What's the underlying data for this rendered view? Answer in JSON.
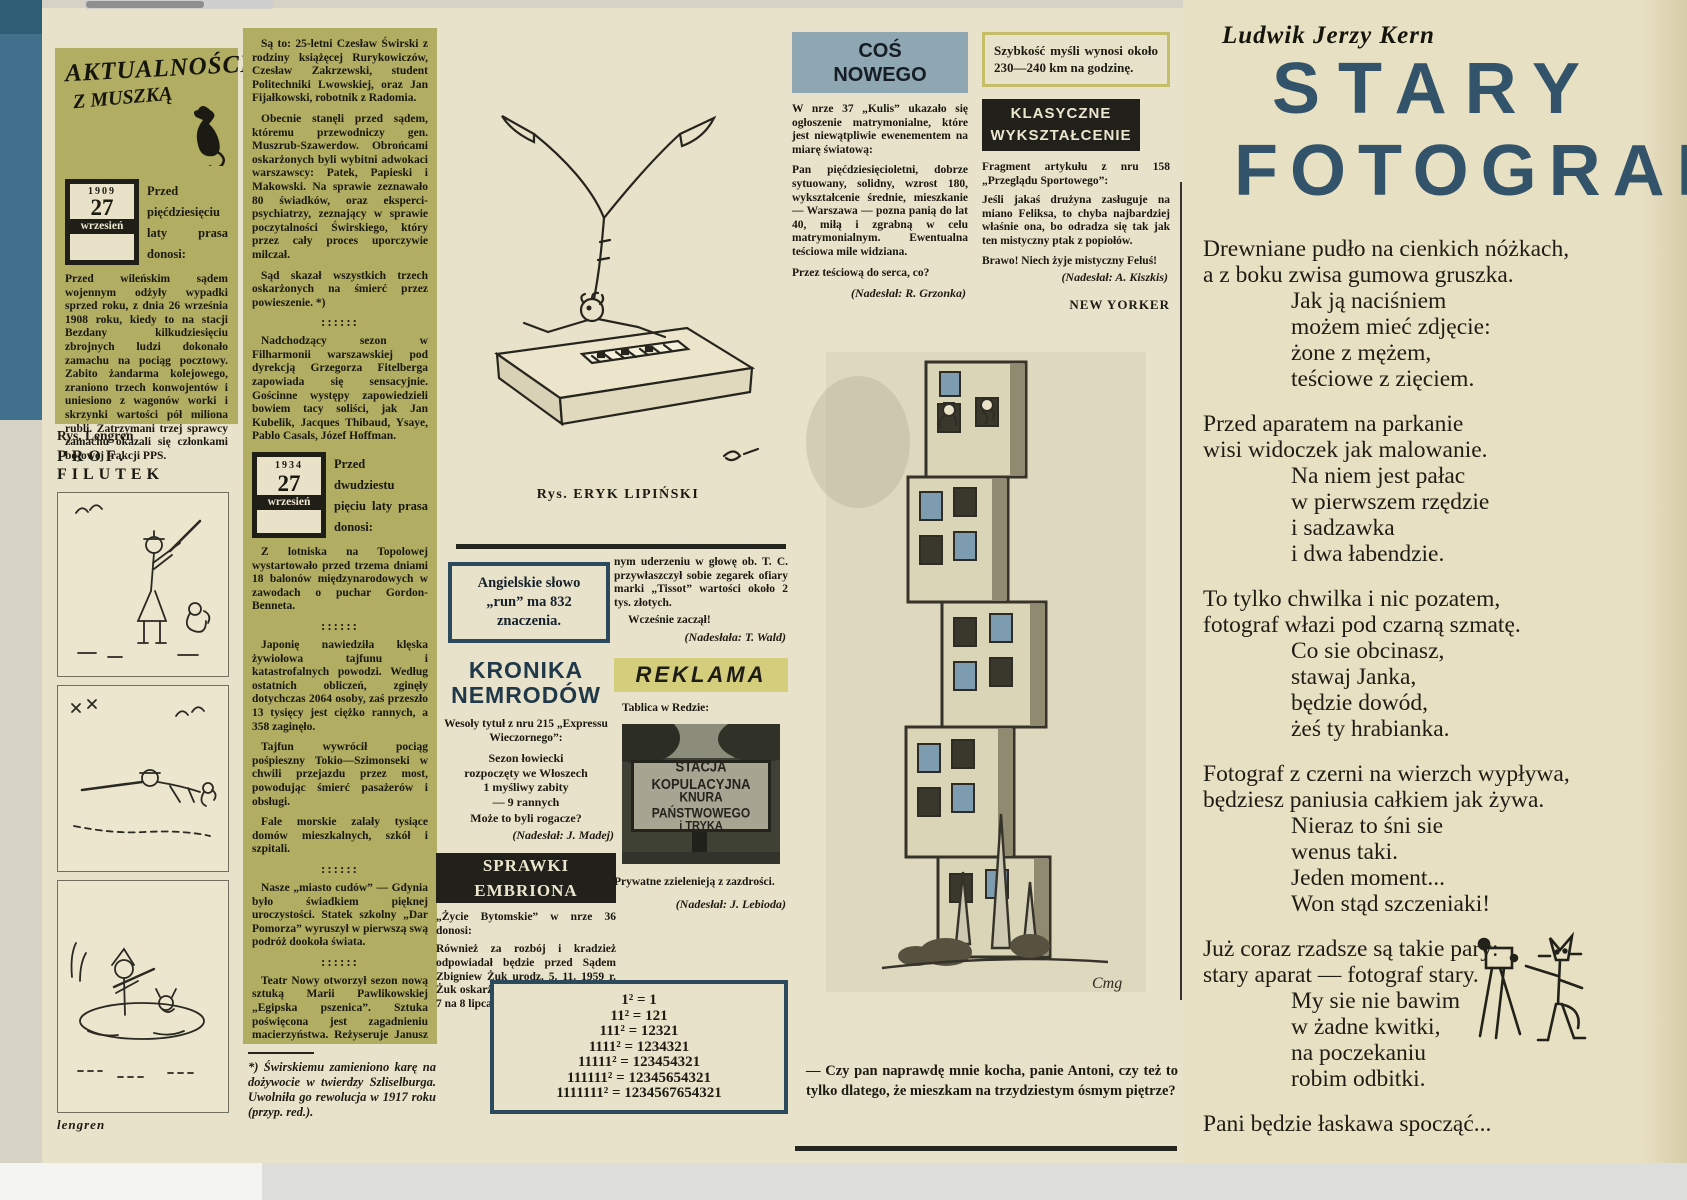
{
  "colors": {
    "paper_left": "#e9e2ca",
    "paper_right": "#e8e0c2",
    "panel_green": "#b1ad62",
    "band_blue": "#8ea7b2",
    "band_yellow": "#d4cd7c",
    "banner_black": "#21201a",
    "headline_blue": "#20394a",
    "poem_title_blue": "#33536b",
    "edge_blue": "#40708b",
    "ink": "#1c1b12"
  },
  "aktualnosci": {
    "logo1": "AKTUALNOŚCI",
    "logo2": "Z MUSZKĄ",
    "box1909": {
      "year": "1909",
      "day": "27",
      "month": "wrzesień"
    },
    "lead1909": "Przed pięćdziesięciu laty prasa donosi:",
    "para1909": "Przed wileńskim sądem wojennym odżyły wypadki sprzed roku, z dnia 26 września 1908 roku, kiedy to na stacji Bezdany kilkudziesięciu zbrojnych ludzi dokonało zamachu na pociąg pocztowy. Zabito żandarma kolejowego, zraniono trzech konwojentów i uniesiono z wagonów worki i skrzynki wartości pół miliona rubli. Zatrzymani trzej sprawcy zamachu okazali się członkami bojowej frakcji PPS.",
    "rys": "Rys. Lengren",
    "filutek": "PROF. FILUTEK",
    "signature": "lengren"
  },
  "col2": {
    "para_a": "Są to: 25-letni Czesław Świrski z rodziny książęcej Rurykowiczów, Czesław Zakrzewski, student Politechniki Lwowskiej, oraz Jan Fijałkowski, robotnik z Radomia.",
    "para_b": "Obecnie stanęli przed sądem, któremu przewodniczy gen. Muszrub-Szawerdow. Obrońcami oskarżonych byli wybitni adwokaci warszawscy: Patek, Papieski i Makowski. Na sprawie zeznawało 80 świadków, oraz eksperci-psychiatrzy, zeznający w sprawie poczytalności Świrskiego, który przez cały proces uporczywie milczał.",
    "para_c": "Sąd skazał wszystkich trzech oskarżonych na śmierć przez powieszenie. *)",
    "sep": "::::::",
    "para_d": "Nadchodzący sezon w Filharmonii warszawskiej pod dyrekcją Grzegorza Fitelberga zapowiada się sensacyjnie. Gościnne występy zapowiedzieli bowiem tacy soliści, jak Jan Kubelik, Jacques Thibaud, Ysaye, Pablo Casals, Józef Hoffman.",
    "box1934": {
      "year": "1934",
      "day": "27",
      "month": "wrzesień"
    },
    "lead1934": "Przed dwudziestu pięciu laty prasa donosi:",
    "para_e": "Z lotniska na Topolowej wystartowało przed trzema dniami 18 balonów międzynarodowych w zawodach o puchar Gordon-Benneta.",
    "para_f": "Japonię nawiedziła klęska żywiołowa tajfunu i katastrofalnych powodzi. Według ostatnich obliczeń, zginęły dotychczas 2064 osoby, zaś przeszło 13 tysięcy jest ciężko rannych, a 358 zaginęło.",
    "para_g": "Tajfun wywrócił pociąg pośpieszny Tokio—Szimonseki w chwili przejazdu przez most, powodując śmierć pasażerów i obsługi.",
    "para_h": "Fale morskie zalały tysiące domów mieszkalnych, szkół i szpitali.",
    "para_i": "Nasze „miasto cudów” — Gdynia było świadkiem pięknej uroczystości. Statek szkolny „Dar Pomorza” wyruszył w pierwszą swą podróż dookoła świata.",
    "para_j": "Teatr Nowy otworzył sezon nową sztuką Marii Pawlikowskiej „Egipska pszenica”. Sztuka poświęcona jest zagadnieniu macierzyństwa. Reżyseruje Janusz Warnecki Grają Dulębianka, Gorczyńska, Buczyńska, Brodniewicz i Pośpielowski.",
    "sig": "(kar. beyl.)",
    "footnote": "*) Świrskiemu zamieniono karę na dożywocie w twierdzy Szliselburga. Uwolniła go rewolucja w 1917 roku (przyp. red.)."
  },
  "lipinski": {
    "caption": "Rys. ERYK LIPIŃSKI"
  },
  "fact_run": "Angielskie słowo „run” ma 832 znaczenia.",
  "kronika": {
    "title1": "KRONIKA",
    "title2": "NEMRODÓW",
    "intro": "Wesoły tytuł z nru 215 „Expressu Wieczornego”:",
    "q1": "Sezon łowiecki",
    "q2": "rozpoczęty we Włoszech",
    "q3": "1 myśliwy zabity",
    "q4": "— 9 rannych",
    "punch": "Może to byli rogacze?",
    "credit": "(Nadesłał: J. Madej)"
  },
  "sprawki": {
    "title": "SPRAWKI EMBRIONA",
    "intro": "„Życie Bytomskie” w nrze 36 donosi:",
    "body": "Również za rozbój i kradzież odpowiadał będzie przed Sądem Zbigniew Żuk urodz. 5. 11. 1959 r. Żuk oskarżony jest o to, że w nocy z 7 na 8 lipca po trzykrot-",
    "cont": "nym uderzeniu w głowę ob. T. C. przywłaszczył sobie zegarek ofiary marki „Tissot” wartości około 2 tys. złotych.",
    "punch": "Wcześnie zaczął!",
    "credit": "(Nadesłała: T. Wald)"
  },
  "reklama": {
    "title": "REKLAMA",
    "intro": "Tablica w Redzie:",
    "sign1": "STACJA KOPULACYJNA",
    "sign2": "KNURA PAŃSTWOWEGO",
    "sign3": "i TRYKA",
    "body": "Prywatne zzielenieją z zazdrości.",
    "credit": "(Nadesłał: J. Lebioda)"
  },
  "math": {
    "lines": [
      "1² = 1",
      "11² = 121",
      "111² = 12321",
      "1111² = 1234321",
      "11111² = 123454321",
      "111111² = 12345654321",
      "1111111² = 1234567654321"
    ]
  },
  "cos_nowego": {
    "title1": "COŚ",
    "title2": "NOWEGO",
    "p1": "W nrze 37 „Kulis” ukazało się ogłoszenie matrymonialne, które jest niewątpliwie ewenementem na miarę światową:",
    "p2": "Pan pięćdziesięcioletni, dobrze sytuowany, solidny, wzrost 180, wykształcenie średnie, mieszkanie — Warszawa — pozna panią do lat 40, miłą i zgrabną w celu matrymonialnym. Ewentualna teściowa mile widziana.",
    "p3": "Przez teściową do serca, co?",
    "credit": "(Nadesłał: R. Grzonka)"
  },
  "speed_fact": "Szybkość myśli wynosi około 230—240 km na godzinę.",
  "klasyczne": {
    "title1": "KLASYCZNE",
    "title2": "WYKSZTAŁCENIE",
    "p1": "Fragment artykułu z nru 158 „Przeglądu Sportowego”:",
    "p2": "Jeśli jakaś drużyna zasługuje na miano Feliksa, to chyba najbardziej właśnie ona, bo odradza się tak jak ten mistyczny ptak z popiołów.",
    "p3": "Brawo! Niech żyje mistyczny Feluś!",
    "credit": "(Nadesłał: A. Kiszkis)"
  },
  "new_yorker": {
    "label": "NEW YORKER",
    "caption": "— Czy pan naprawdę mnie kocha, panie Antoni, czy też to tylko dlatego, że mieszkam na trzydziestym ósmym piętrze?",
    "signature": "Cmg"
  },
  "poem": {
    "author": "Ludwik Jerzy Kern",
    "title1": "STARY",
    "title2": "FOTOGRAF",
    "s1": [
      "Drewniane pudło na cienkich nóżkach,",
      "a z boku zwisa gumowa gruszka.",
      "Jak ją naciśniem",
      "możem mieć zdjęcie:",
      "żone z mężem,",
      "teściowe z zięciem."
    ],
    "s2": [
      "Przed aparatem na parkanie",
      "wisi widoczek jak malowanie.",
      "Na niem jest pałac",
      "w pierwszem rzędzie",
      "i sadzawka",
      "i dwa łabendzie."
    ],
    "s3": [
      "To tylko chwilka i nic pozatem,",
      "fotograf włazi pod czarną szmatę.",
      "Co sie obcinasz,",
      "stawaj Janka,",
      "będzie dowód,",
      "żeś ty hrabianka."
    ],
    "s4": [
      "Fotograf z czerni na wierzch wypływa,",
      "będziesz paniusia całkiem jak żywa.",
      "Nieraz to śni sie",
      "wenus taki.",
      "Jeden moment...",
      "Won stąd szczeniaki!"
    ],
    "s5": [
      "Już coraz rzadsze są takie pary:",
      "stary aparat — fotograf stary.",
      "My sie nie bawim",
      "w żadne kwitki,",
      "na poczekaniu",
      "robim odbitki."
    ],
    "closing": "Pani będzie łaskawa spocząć..."
  }
}
